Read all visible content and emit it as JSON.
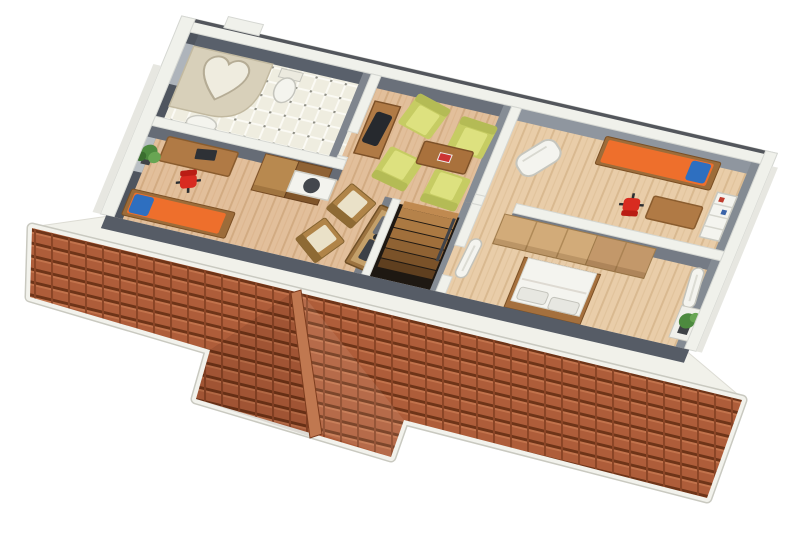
{
  "scene": {
    "title": "3D axonometric floor plan of an upper storey with terracotta roof",
    "view": "cutaway model seen from the south-west, white background",
    "visible_text": ""
  },
  "palette": {
    "background": "#ffffff",
    "roof_tile": "#ae5d3a",
    "roof_course_line": "#6e3418",
    "roof_joint_line": "#8a4526",
    "roof_ridge": "#c07850",
    "roof_fascia": "#f2f2ec",
    "eaves_strip": "#f1f1ea",
    "wood_floor_left": "#e2bf9b",
    "wood_floor_right": "#e9cda9",
    "wood_plank_line": "#d2ab82",
    "bath_tile": "#efede0",
    "wall_top_white": "#f0f1eb",
    "wall_face_dark": "#59606b",
    "wall_face_mid": "#8f969f",
    "wall_south_band": "#565c66",
    "window_glass": "#aeb4bb",
    "furniture_wood": "#b07a45",
    "wood_edge": "#8a5c2e",
    "wardrobe_light": "#b8894f",
    "wardrobe_dark": "#8f6234",
    "closet_light": "#d2ab79",
    "closet_mid": "#c3986a",
    "bed_orange": "#ee6f2c",
    "pillow_blue": "#2e6fc0",
    "chair_red": "#d82b20",
    "chair_red_dark": "#b91d14",
    "armchair_green": "#c6cc63",
    "armchair_cushion": "#dde17f",
    "cream_cushion": "#eae1c8",
    "white_furniture": "#f4f4ef",
    "tub_platform": "#d8d0ba",
    "plant_green": "#4d8a3f",
    "stair_hole": "#1e1812"
  },
  "rooms": [
    {
      "name": "bathroom",
      "position": "top-left",
      "floor": "white tiles with dot grid",
      "furniture": [
        "heart-shaped-bathtub-platform",
        "toilet",
        "sink-bidet",
        "west-window"
      ]
    },
    {
      "name": "office-bedroom-left",
      "position": "left",
      "floor": "light oak",
      "furniture": [
        "desk-with-laptop",
        "red-office-chair",
        "two-tone-wardrobe",
        "orange-daybed-with-blue-pillow",
        "potted-plant"
      ]
    },
    {
      "name": "living-room",
      "position": "center-top",
      "floor": "light oak",
      "furniture": [
        "sideboard-with-tv",
        "armchair-1",
        "armchair-2",
        "armchair-3",
        "armchair-4",
        "coffee-table",
        "kitchenette-counter-with-sink"
      ]
    },
    {
      "name": "hallway-landing",
      "position": "center-bottom",
      "floor": "light oak",
      "furniture": [
        "cushion-chair-1",
        "cushion-chair-2",
        "bench-table-with-tools",
        "staircase-down"
      ]
    },
    {
      "name": "bedroom-top-right",
      "position": "right-top",
      "floor": "light oak",
      "furniture": [
        "white-rocking-chair",
        "orange-single-bed-with-blue-pillow",
        "desk",
        "red-office-chair",
        "white-wall-shelf"
      ]
    },
    {
      "name": "bedroom-bottom-right",
      "position": "right-bottom",
      "floor": "light oak",
      "furniture": [
        "long-wardrobe",
        "white-double-bed-with-two-pillows",
        "white-radiator-1",
        "white-radiator-2",
        "plant-in-wall-niche"
      ]
    }
  ],
  "roof": {
    "material": "terracotta tiles",
    "sections": [
      "main-south-band",
      "front-dormer-with-ridge"
    ],
    "trim": "white fascia strips"
  }
}
